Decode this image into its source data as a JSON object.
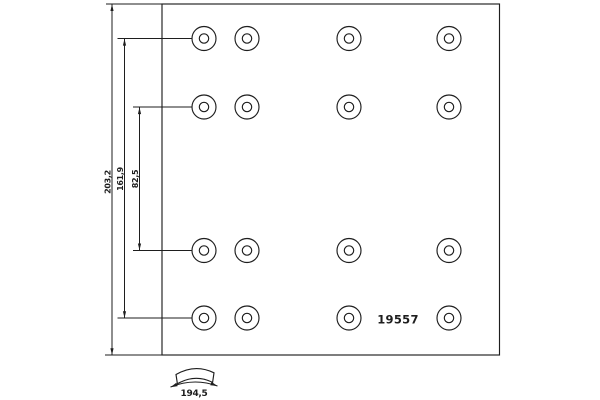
{
  "drawing": {
    "part_number": "19557",
    "dimensions": {
      "total_width": "203,2",
      "outer_rows_spacing": "161,9",
      "inner_rows_spacing": "82,5",
      "arc_width": "194,5"
    },
    "holes": {
      "count": 16,
      "columns_x": [
        204,
        247,
        349,
        449
      ],
      "rows_y": [
        38.5,
        107,
        250.5,
        318
      ],
      "outer_radius": 12,
      "inner_radius": 4.7
    },
    "outline": {
      "x": 162,
      "y": 4,
      "width": 337.5,
      "height": 351
    },
    "colors": {
      "line": "#1e1e1e",
      "background": "#ffffff"
    }
  }
}
